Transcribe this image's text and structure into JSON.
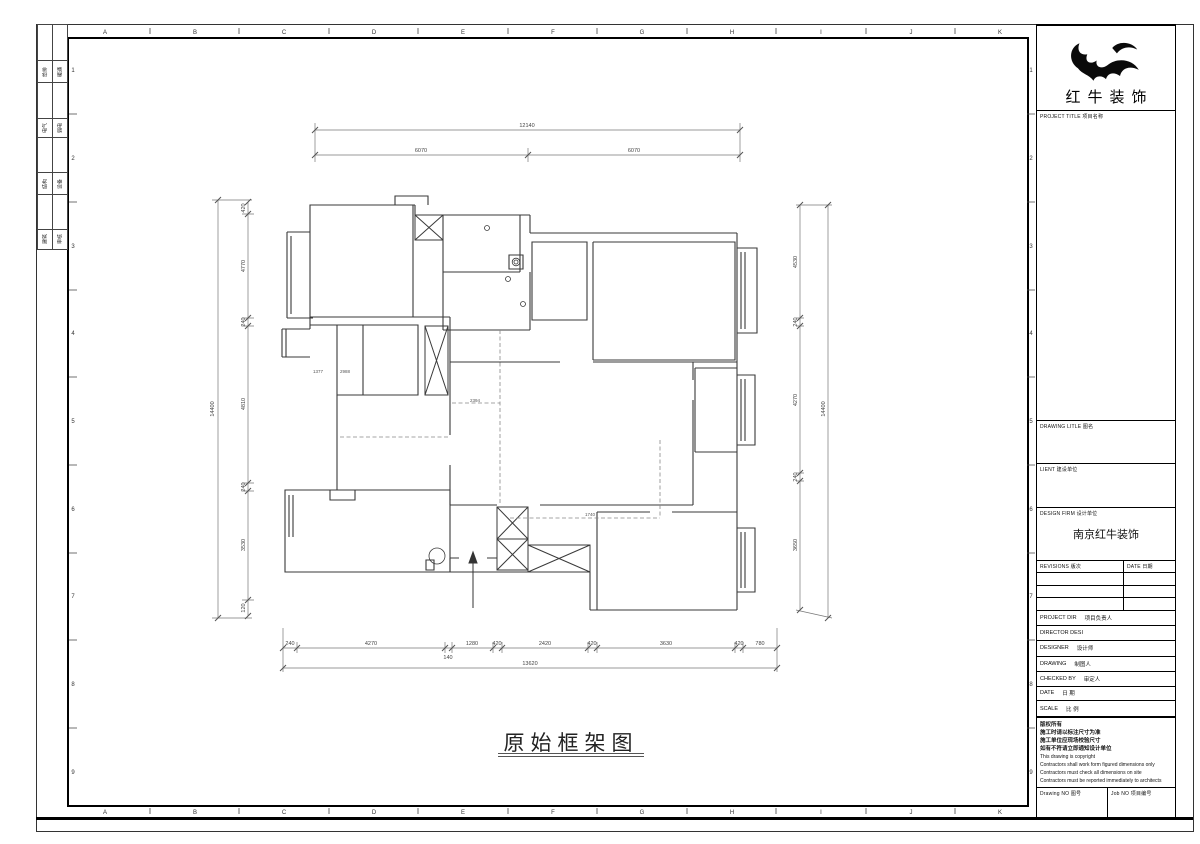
{
  "sheet": {
    "title": "原始框架图",
    "grid_letters": [
      "A",
      "B",
      "C",
      "D",
      "E",
      "F",
      "G",
      "H",
      "I",
      "J",
      "K"
    ],
    "grid_numbers": [
      "1",
      "2",
      "3",
      "4",
      "5",
      "6",
      "7",
      "8",
      "9"
    ]
  },
  "signoff": {
    "cells": [
      "给排",
      "暖通",
      "电气",
      "弱电",
      "结构",
      "设备",
      "建筑",
      "审核"
    ]
  },
  "title_block": {
    "company": "红牛装饰",
    "project_title_label": "PROJECT TITLE  项目名称",
    "drawing_title_label": "DRAWING LITLE  图名",
    "client_label": "LIENT  建设单位",
    "design_firm_label": "DESIGN FIRM  设计单位",
    "design_firm_value": "南京红牛装饰",
    "revisions_label": "REVISIONS  版次",
    "revisions_date_label": "DATE  日期",
    "rows": [
      {
        "en": "PROJECT DIR",
        "cn": "项目负责人"
      },
      {
        "en": "DIRECTOR DESI",
        "cn": ""
      },
      {
        "en": "DESIGNER",
        "cn": "设计师"
      },
      {
        "en": "DRAWING",
        "cn": "制图人"
      },
      {
        "en": "CHECKED BY",
        "cn": "审定人"
      },
      {
        "en": "DATE",
        "cn": "日  期"
      },
      {
        "en": "SCALE",
        "cn": "比  例"
      }
    ],
    "copyright_lines": [
      "版权所有",
      "施工时请以标注尺寸为准",
      "施工单位应现场校验尺寸",
      "如有不符请立即通知设计单位",
      "This drawing is copyright",
      "Contractors shall work form figured dimensions only",
      "Contractors must check all dimensions on site",
      "Contractors must be reported immediately to architects"
    ],
    "drawing_no_label": "Drawing NO  图号",
    "job_no_label": "Job NO  项目编号"
  },
  "dims": {
    "top": {
      "overall": "12140",
      "segments": [
        "6070",
        "6070"
      ]
    },
    "bottom": {
      "overall": "13620",
      "segments": [
        "240",
        "4270",
        "140",
        "1280",
        "420",
        "2420",
        "420",
        "3630",
        "420",
        "780"
      ]
    },
    "left": {
      "overall": "14400",
      "segments": [
        "420",
        "4770",
        "240",
        "4810",
        "240",
        "3530",
        "120"
      ]
    },
    "right": {
      "overall": "14400",
      "segments": [
        "4530",
        "240",
        "4270",
        "240",
        "3650"
      ]
    }
  },
  "plan": {
    "labels": [
      "1377",
      "2988",
      "2394",
      "1740"
    ]
  },
  "colors": {
    "frame": "#000000",
    "wall": "#3a3a3a",
    "dim": "#666666"
  }
}
